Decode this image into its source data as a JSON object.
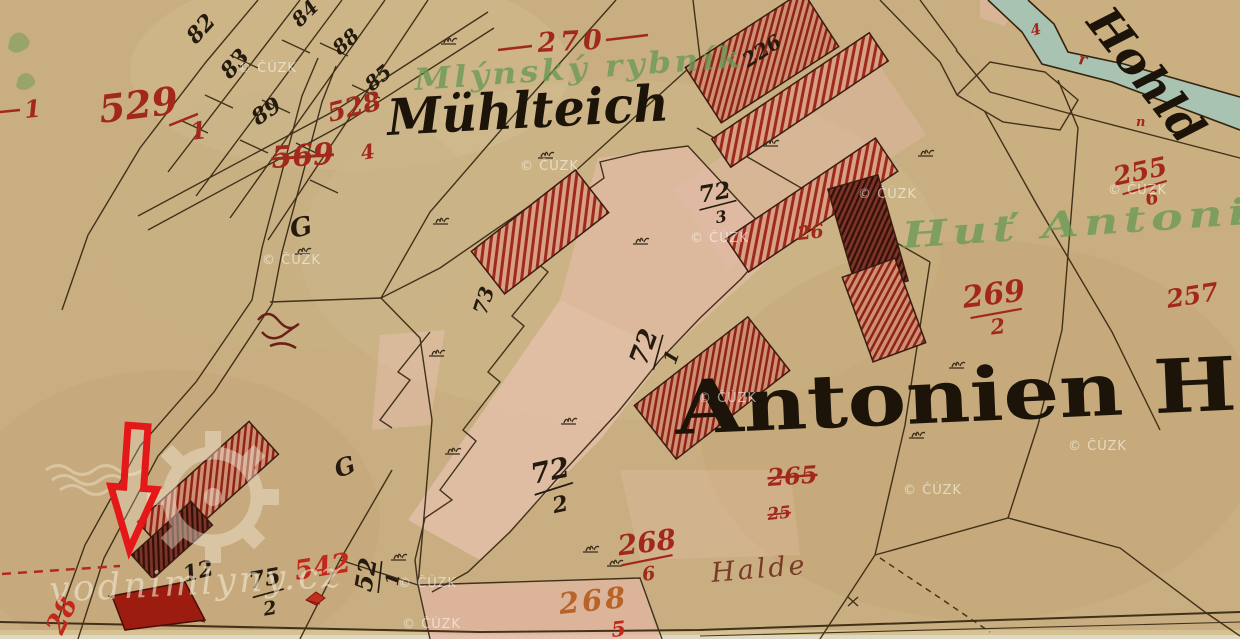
{
  "viewer": {
    "width": 1240,
    "height": 639,
    "kind": "historical cadastral map scan"
  },
  "map": {
    "place_labels": {
      "pond": "Mühlteich",
      "smeltery": "Antonien H",
      "hollow_way": "Hohld",
      "heap": "Halde"
    },
    "green_notes": {
      "pond_czech": "Mlýnský rybník",
      "smeltery_czech": "Huť Antoni"
    },
    "symbols": {
      "garden_1": "G",
      "garden_2": "G"
    },
    "red_numbers": {
      "edge_left": "1",
      "n529": {
        "num": "529",
        "den": "1"
      },
      "n569": "569",
      "n528": "528",
      "n528_den": "4",
      "n270": "270",
      "n26": "26",
      "n269": {
        "num": "269",
        "den": "2"
      },
      "n255": {
        "num": "255",
        "den": "6"
      },
      "n257": "257",
      "n265_struck": "265",
      "n25_struck": "25",
      "n268": {
        "num": "268",
        "den": "6"
      },
      "n268_orange": "268",
      "n268_orange_den": "5",
      "n542": "542",
      "n28": "28",
      "teal_mark_1": "4",
      "teal_mark_2": "r",
      "teal_mark_3": "n"
    },
    "black_numbers": {
      "n82": "82",
      "n83": "83",
      "n89": "89",
      "n84": "84",
      "n88": "88",
      "n85": "85",
      "n226_building": "226",
      "n73": "73",
      "n72_3": {
        "num": "72",
        "den": "3"
      },
      "n72_1": {
        "num": "72",
        "den": "1"
      },
      "n72_2": {
        "num": "72",
        "den": "2"
      },
      "n52_1": {
        "num": "52",
        "den": "1"
      },
      "n12": "12",
      "n75_2": {
        "num": "75",
        "den": "2"
      }
    },
    "watermarks": {
      "cuzk": "© ČÚZK",
      "site": "vodnimlyny.cz"
    },
    "colors": {
      "paper": "#c8ae80",
      "paper_light": "#d7c298",
      "ink": "#32240f",
      "red_ink": "#a3281c",
      "bright_red_arrow": "#e41818",
      "orange_ink": "#b86328",
      "green_ink": "#6b9a55",
      "parcel_pink": "#e6bcab",
      "building_hatch": "#9e2b1a",
      "building_dark": "#5e241a",
      "water": "#a9c3b2",
      "watermark": "#ffffff"
    }
  }
}
